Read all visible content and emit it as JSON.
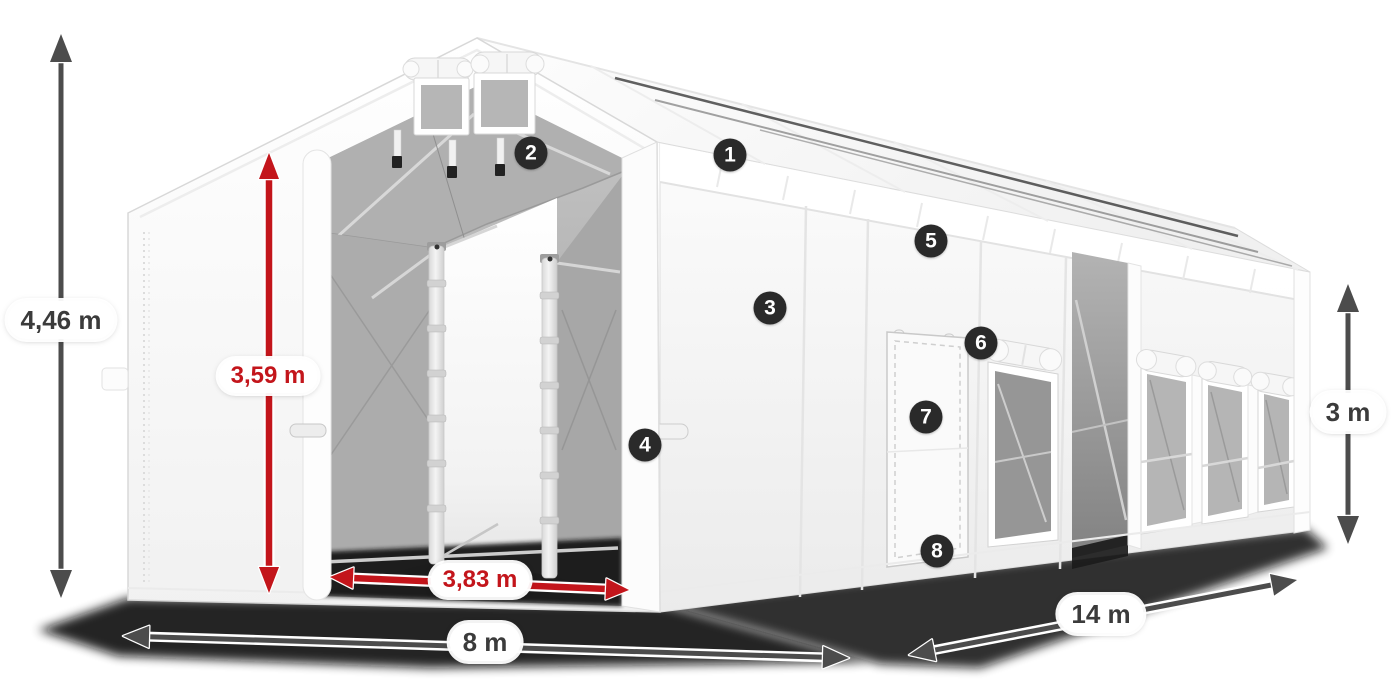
{
  "dimensions": {
    "total_height": {
      "label": "4,46 m",
      "style": "gray"
    },
    "entrance_height": {
      "label": "3,59 m",
      "style": "red"
    },
    "entrance_width": {
      "label": "3,83 m",
      "style": "red"
    },
    "front_width": {
      "label": "8 m",
      "style": "gray"
    },
    "side_length": {
      "label": "14 m",
      "style": "gray"
    },
    "side_wall_height": {
      "label": "3 m",
      "style": "gray"
    }
  },
  "callouts": [
    {
      "number": "1"
    },
    {
      "number": "2"
    },
    {
      "number": "3"
    },
    {
      "number": "4"
    },
    {
      "number": "5"
    },
    {
      "number": "6"
    },
    {
      "number": "7"
    },
    {
      "number": "8"
    }
  ],
  "colors": {
    "red_accent": "#c3151b",
    "gray_arrow": "#4c4c4c",
    "label_text": "#3b3b3b",
    "callout_bg": "#2a2a2a",
    "callout_text": "#ffffff",
    "tent_white": "#ffffff",
    "interior_gray": "#a9a9a9",
    "background": "#ffffff"
  }
}
